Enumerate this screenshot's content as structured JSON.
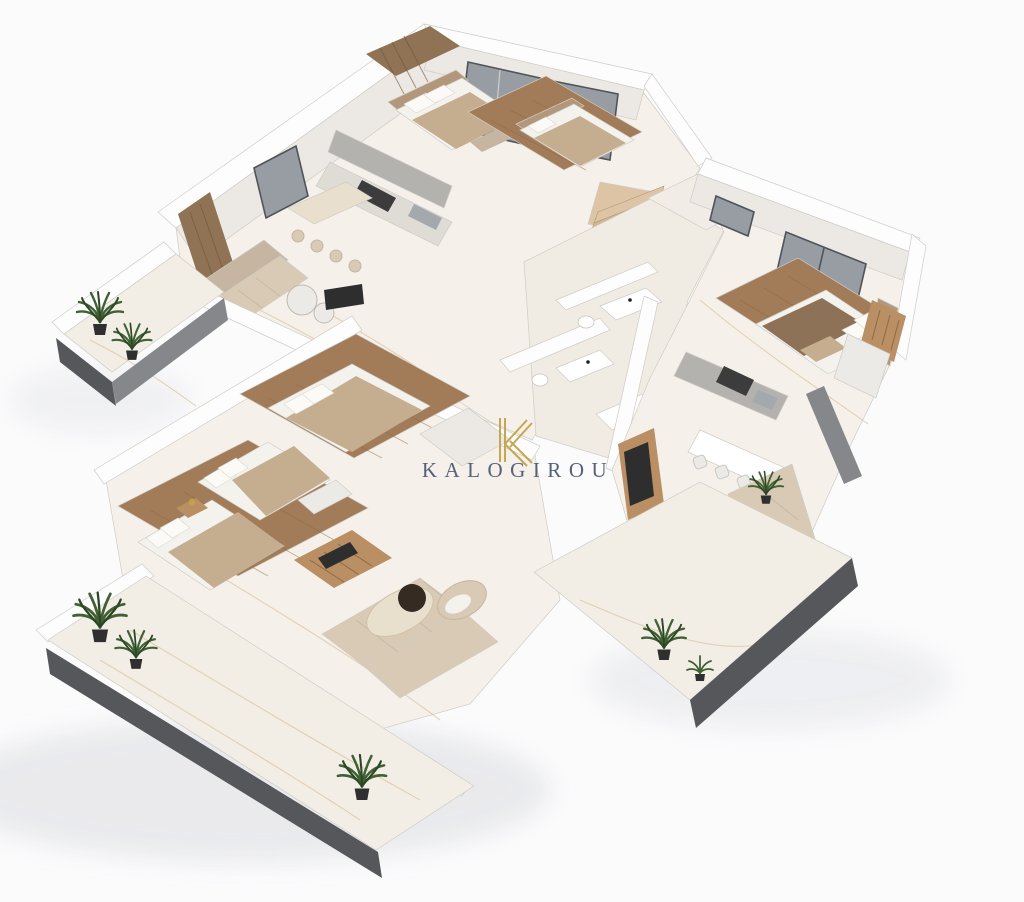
{
  "watermark": {
    "monogram": "K",
    "brand": "KALOGIROU"
  },
  "colors": {
    "background": "#fbfbfc",
    "shadow": "#dcdde1",
    "marble": "#f5f1ea",
    "marble_core": "#f0ebe3",
    "marble_balcony": "#f2eee6",
    "vein": "#cfa873",
    "wall_top": "#fdfdfd",
    "wall_side": "#ece9e5",
    "wall_gray": "#c9c8c6",
    "wall_outline": "#cfccc7",
    "slab_dark": "#55575b",
    "slab_mid": "#85878b",
    "glass": "#979da3",
    "glass_frame": "#4e545a",
    "wood_floor": "#a27c58",
    "wood_plank": "#8a6743",
    "wood_wall": "#8f7354",
    "stair_a": "#dcc4a4",
    "stair_b": "#cfb694",
    "stair_edge": "#b3966f",
    "counter_gray": "#b4b2af",
    "counter_dark": "#3c3c3c",
    "island_light": "#dfdcd6",
    "steel": "#a4a9ad",
    "sofa": "#d8cab5",
    "sofa_shade": "#c6b5a0",
    "mattress": "#f4f2ed",
    "pillow": "#fbfaf7",
    "blanket_beige": "#c5ad90",
    "blanket_brown": "#8d7257",
    "headboard": "#b2977a",
    "table_cream": "#e9dfcd",
    "table_dark": "#352b23",
    "wardrobe_wood": "#b98f63",
    "tv_dark": "#2e2e2e",
    "chair_white": "#eceae6",
    "plant": "#3f6134",
    "plant_dark": "#2c4724",
    "pot": "#2f2f30",
    "gold": "#c3a146",
    "brand_text": "#4a5670"
  },
  "scene": {
    "type": "3d-floor-plan-render",
    "features": [
      "top apartment with open kitchen island and bar stools",
      "middle bedroom behind sliding glass doors",
      "right apartment with bedroom, kitchen, dining counter and corner sofa",
      "lower apartment with three bedrooms and living room",
      "central wooden staircase",
      "two bathrooms with sinks and toilets",
      "four balconies with potted palm plants",
      "white marble floors with gold veining",
      "dark floor-slab edges"
    ]
  }
}
